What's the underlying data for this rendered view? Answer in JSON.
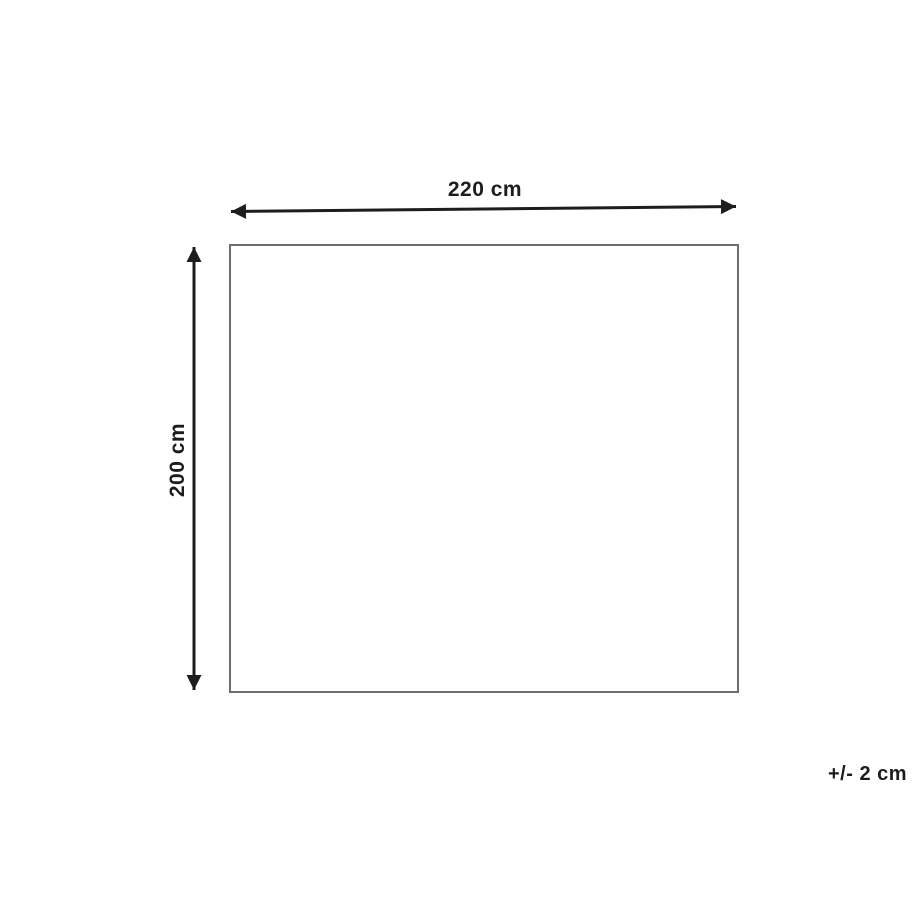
{
  "diagram": {
    "dimensions": {
      "width_label": "220 cm",
      "height_label": "200 cm",
      "tolerance_label": "+/- 2 cm"
    },
    "colors": {
      "arrow": "#1d1d1b",
      "outline": "#6e6e6e",
      "background": "#ffffff"
    }
  }
}
